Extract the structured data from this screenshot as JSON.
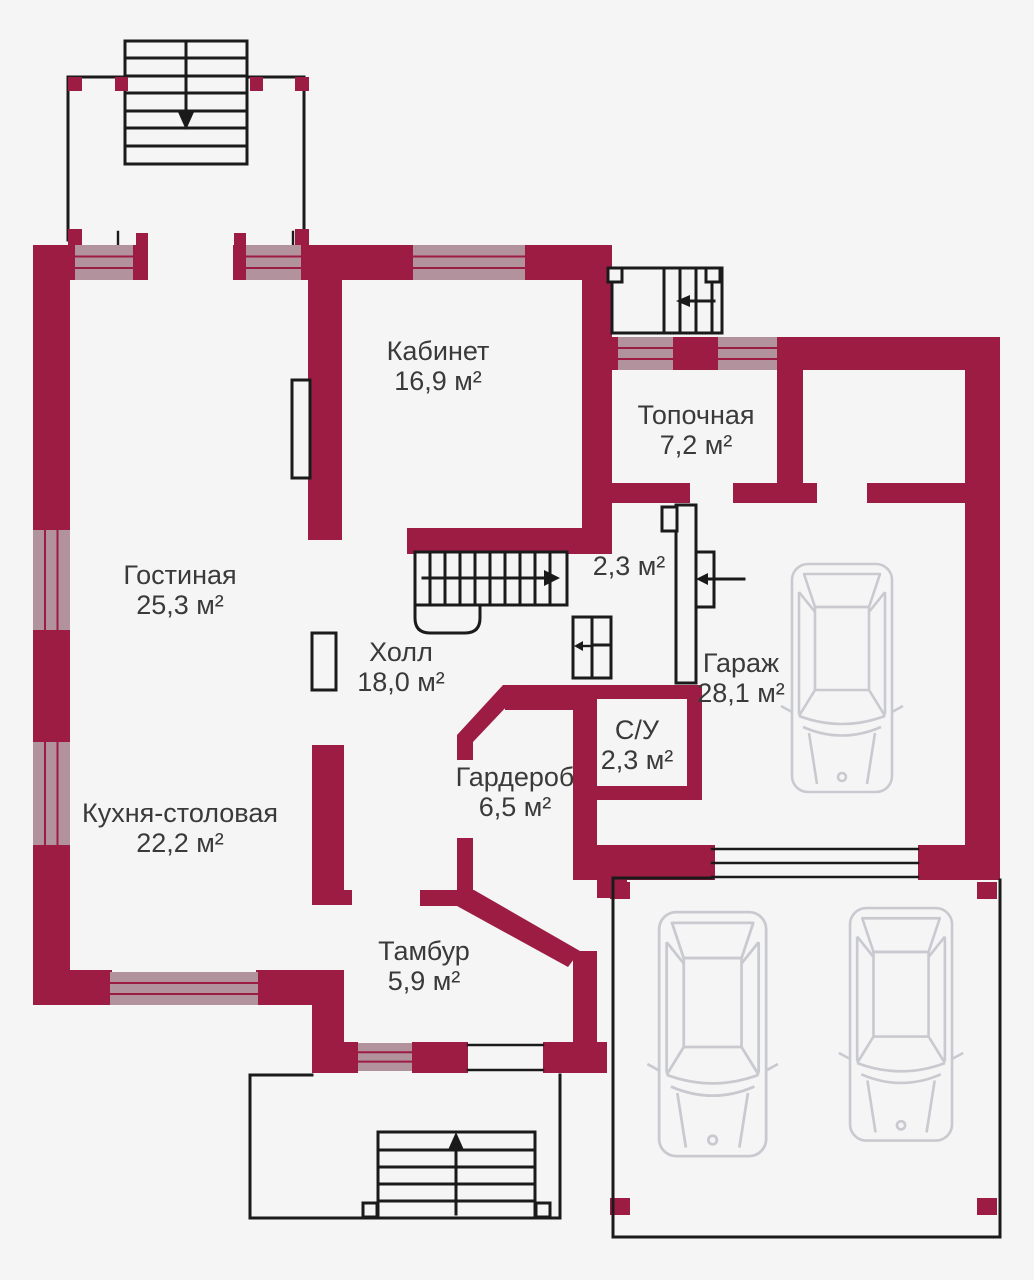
{
  "plan": {
    "type": "floor-plan",
    "rooms": [
      {
        "name": "Кабинет",
        "area": "16,9 м²"
      },
      {
        "name": "Топочная",
        "area": "7,2 м²"
      },
      {
        "name": "Гостиная",
        "area": "25,3 м²"
      },
      {
        "name": "Холл",
        "area": "18,0 м²"
      },
      {
        "name": "",
        "area": "2,3 м²"
      },
      {
        "name": "Гараж",
        "area": "28,1 м²"
      },
      {
        "name": "С/У",
        "area": "2,3 м²"
      },
      {
        "name": "Гардероб",
        "area": "6,5 м²"
      },
      {
        "name": "Кухня-столовая",
        "area": "22,2 м²"
      },
      {
        "name": "Тамбур",
        "area": "5,9 м²"
      }
    ],
    "colors": {
      "wall": "#9d1c44",
      "window": "#b2929c",
      "background": "#f6f5f6",
      "outline": "#1a1a1a",
      "car": "#c9cad0",
      "text": "#3a3a3a"
    }
  }
}
